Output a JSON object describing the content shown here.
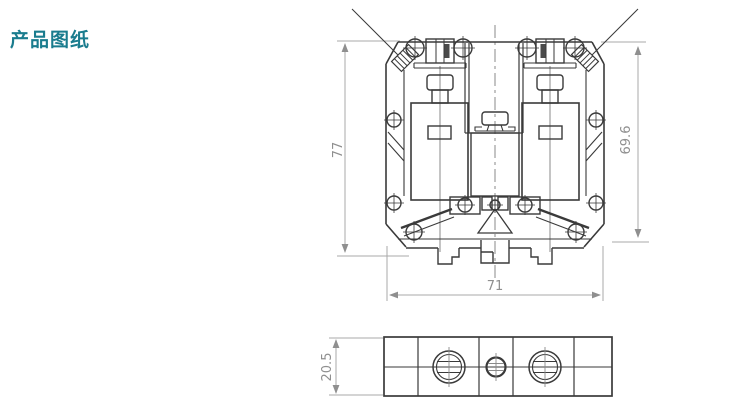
{
  "page": {
    "title": "产品图纸",
    "title_color": "#1a7c8e",
    "background_color": "#ffffff"
  },
  "drawing": {
    "subject": "din-rail-terminal-block",
    "line_color": "#3a3a3a",
    "dimension_line_color": "#a8a8a8",
    "dimension_text_color": "#8f8f8f",
    "views": {
      "front_view": "terminal-block-front-section",
      "bottom_view": "terminal-block-bottom-view"
    },
    "dimensions": {
      "total_height": "77",
      "body_height": "69.6",
      "total_width": "71",
      "depth": "20.5"
    }
  }
}
